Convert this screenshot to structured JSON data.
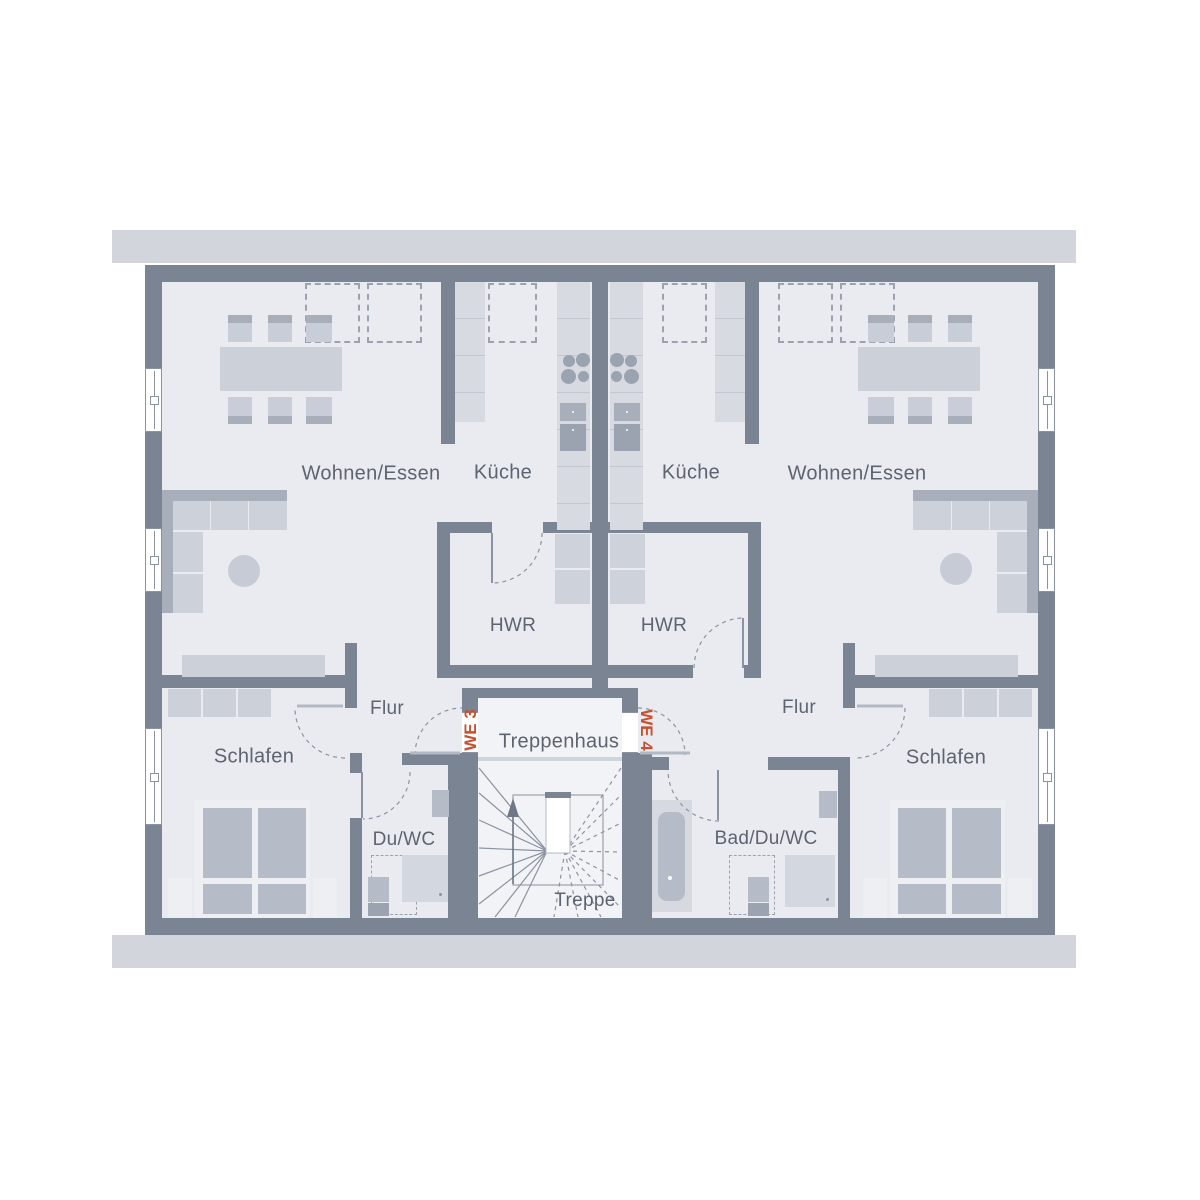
{
  "plan": {
    "units": {
      "we3": {
        "label": "WE 3",
        "living": "Wohnen/Essen",
        "kitchen": "Küche",
        "utility": "HWR",
        "hall": "Flur",
        "bedroom": "Schlafen",
        "bath": "Du/WC"
      },
      "we4": {
        "label": "WE 4",
        "living": "Wohnen/Essen",
        "kitchen": "Küche",
        "utility": "HWR",
        "hall": "Flur",
        "bedroom": "Schlafen",
        "bath": "Bad/Du/WC"
      }
    },
    "core": {
      "stairwell": "Treppenhaus",
      "stairs": "Treppe"
    }
  },
  "icons": {
    "stairs_direction": "up-arrow-icon",
    "cooktop": "cooktop-burners-icon",
    "roof_window": "dashed-roof-window"
  },
  "colors": {
    "wall": "#7b8493",
    "floor": "#e9ebf1",
    "roofband": "#d3d5dc",
    "corefloor": "#f2f3f6",
    "furnlight": "#d3d7df",
    "furnmid": "#c7cbd5",
    "furndark": "#a8afbb",
    "appliance": "#9ba3b0",
    "line": "#8b93a2",
    "text": "#5d6470",
    "accent": "#c8502e",
    "bedframe": "#edeff3"
  }
}
